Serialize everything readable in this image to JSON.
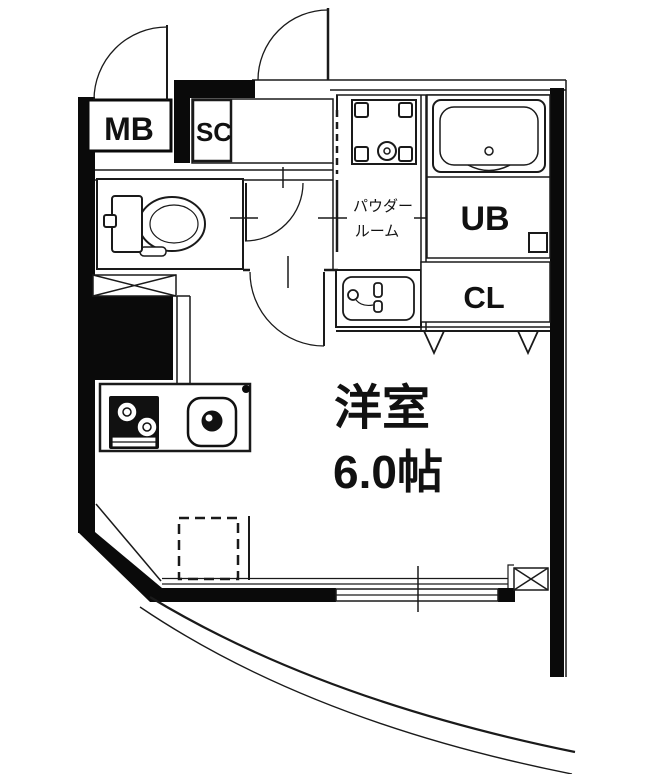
{
  "floorplan": {
    "rooms": {
      "meter_box": {
        "label": "MB"
      },
      "shoe_closet": {
        "label": "SC"
      },
      "powder_room": {
        "label_line1": "パウダー",
        "label_line2": "ルーム"
      },
      "unit_bath": {
        "label": "UB"
      },
      "closet": {
        "label": "CL"
      },
      "western_room": {
        "name": "洋室",
        "size": "6.0帖"
      }
    },
    "colors": {
      "wall": "#0a0a0a",
      "line": "#1a1a1a",
      "background": "#ffffff"
    }
  }
}
